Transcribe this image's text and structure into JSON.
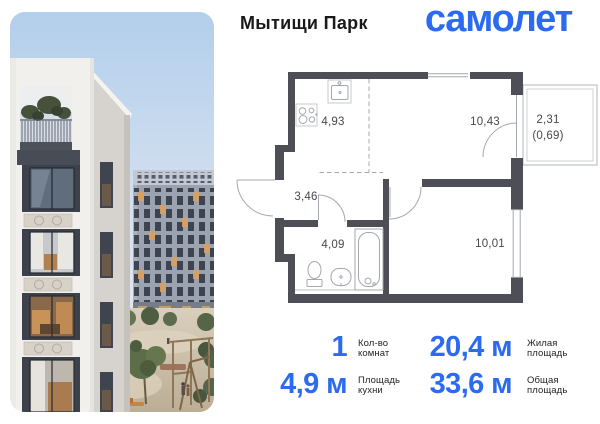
{
  "header": {
    "project_name": "Мытищи Парк",
    "brand": "самолет"
  },
  "colors": {
    "brand_blue": "#2b6bf2",
    "wall": "#4d4e56",
    "plan_line": "#a4a8b0",
    "plan_label": "#47474d",
    "stat_label": "#242428"
  },
  "floor_plan": {
    "rooms": {
      "kitchen": {
        "area": "4,93"
      },
      "room_top": {
        "area": "10,43"
      },
      "balcony": {
        "area": "2,31",
        "reduced_area": "(0,69)"
      },
      "hallway": {
        "area": "3,46"
      },
      "bathroom": {
        "area": "4,09"
      },
      "room_bottom": {
        "area": "10,01"
      }
    },
    "icons": [
      "stove-icon",
      "sink-icon",
      "toilet-icon",
      "washbasin-icon",
      "bathtub-icon"
    ]
  },
  "stats": {
    "rooms": {
      "value": "1",
      "label": [
        "Кол-во",
        "комнат"
      ]
    },
    "living_area": {
      "value": "20,4 м",
      "label": [
        "Жилая",
        "площадь"
      ]
    },
    "kitchen_area": {
      "value": "4,9 м",
      "label": [
        "Площадь",
        "кухни"
      ]
    },
    "total_area": {
      "value": "33,6 м",
      "label": [
        "Общая",
        "площадь"
      ]
    }
  }
}
